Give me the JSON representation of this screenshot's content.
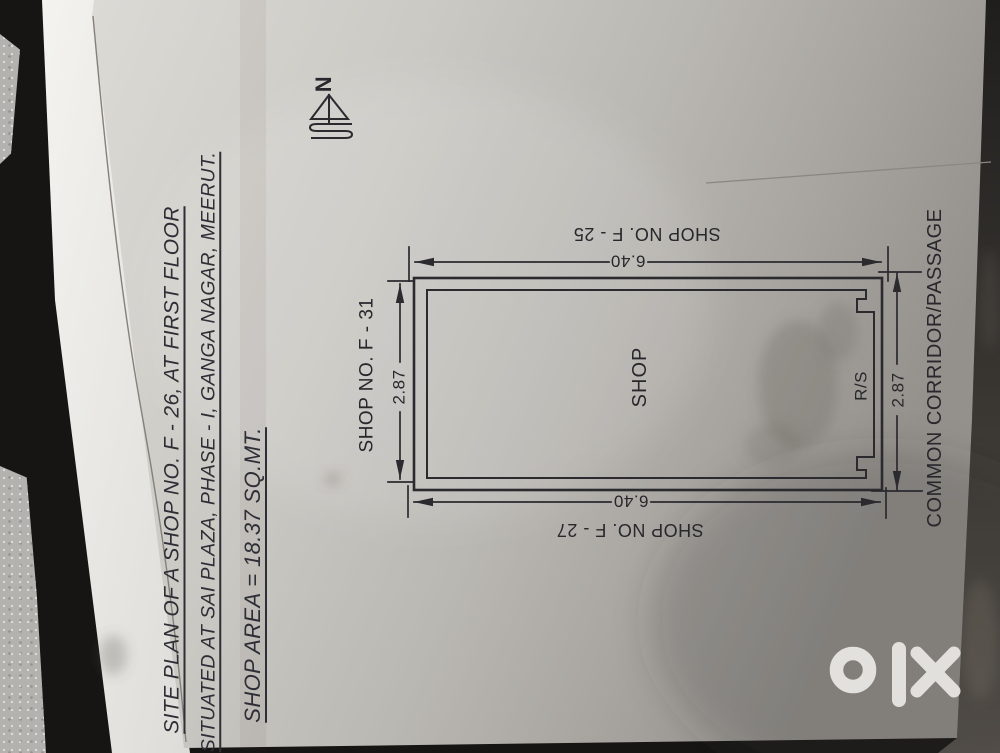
{
  "watermark": {
    "logo_name": "olx"
  },
  "document": {
    "title_block": {
      "line1": "SITE PLAN OF A SHOP NO. F - 26, AT FIRST FLOOR",
      "line2": "SITUATED AT SAI PLAZA, PHASE - I, GANGA NAGAR, MEERUT.",
      "line3": "SHOP AREA = 18.37 SQ.MT."
    },
    "plan": {
      "north_label": "N",
      "room_label": "SHOP",
      "shutter_label": "R/S",
      "neighbor_shop_f31": "SHOP NO. F - 31",
      "neighbor_shop_f25": "SHOP NO. F - 25",
      "neighbor_shop_f27": "SHOP NO. F - 27",
      "corridor_label": "COMMON CORRIDOR/PASSAGE",
      "length_dim": "6.40",
      "width_dim": "2.87"
    },
    "colors": {
      "ink": "#2a2a2f",
      "paper": "#c9c7c2",
      "background": "#161514"
    }
  }
}
